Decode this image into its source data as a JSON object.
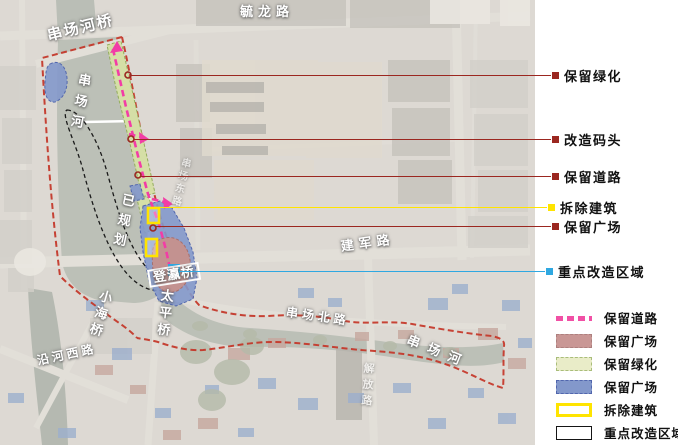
{
  "colors": {
    "callout_red": "#9b2720",
    "demolish_yellow": "#ffe400",
    "focus_cyan": "#2fa8e1",
    "road_magenta": "#f23da6",
    "boundary_red": "#c43527",
    "green_fill": "#d5dfa6",
    "blue_fill": "#8398cb",
    "rose_fill": "#c39290"
  },
  "callouts": [
    {
      "id": "retain-greenery",
      "label": "保留绿化",
      "color": "red",
      "y": 75,
      "x1": 131,
      "x2": 551
    },
    {
      "id": "renovate-dock",
      "label": "改造码头",
      "color": "red",
      "y": 139,
      "x1": 134,
      "x2": 551
    },
    {
      "id": "retain-road",
      "label": "保留道路",
      "color": "red",
      "y": 176,
      "x1": 141,
      "x2": 551
    },
    {
      "id": "demolish-building",
      "label": "拆除建筑",
      "color": "yellow",
      "y": 207,
      "x1": 159,
      "x2": 547
    },
    {
      "id": "retain-plaza",
      "label": "保留广场",
      "color": "red",
      "y": 226,
      "x1": 156,
      "x2": 551
    },
    {
      "id": "key-renovation-area",
      "label": "重点改造区域",
      "color": "cyan",
      "y": 271,
      "x1": 179,
      "x2": 545
    }
  ],
  "legend": {
    "items": [
      {
        "label": "保留道路",
        "swatch": "dash-magenta"
      },
      {
        "label": "保留广场",
        "swatch": "fill-rose"
      },
      {
        "label": "保留绿化",
        "swatch": "fill-green"
      },
      {
        "label": "保留广场",
        "swatch": "fill-blue"
      },
      {
        "label": "拆除建筑",
        "swatch": "outline-yellow"
      },
      {
        "label": "重点改造区域",
        "swatch": "outline-black"
      }
    ]
  },
  "map_labels": [
    {
      "id": "yulong-road",
      "text": "毓龙路",
      "x": 240,
      "y": 5,
      "rot": 0,
      "vertical": false,
      "size": 13,
      "ls": 5
    },
    {
      "id": "chuanchang-river-bridge",
      "text": "串场河桥",
      "x": 46,
      "y": 30,
      "rot": -14,
      "vertical": false,
      "size": 15,
      "ls": 2
    },
    {
      "id": "chuanchang-river-north",
      "text": "串场河",
      "x": 78,
      "y": 72,
      "rot": 10,
      "vertical": true,
      "size": 13,
      "ls": 8
    },
    {
      "id": "planned-area",
      "text": "已规划",
      "x": 122,
      "y": 192,
      "rot": 12,
      "vertical": true,
      "size": 13,
      "ls": 7
    },
    {
      "id": "dengying-bridge",
      "text": "登瀛桥",
      "x": 147,
      "y": 270,
      "rot": -9,
      "vertical": false,
      "size": 13,
      "ls": 1,
      "boxed": true
    },
    {
      "id": "xiaohai-bridge",
      "text": "小海桥",
      "x": 100,
      "y": 288,
      "rot": 16,
      "vertical": true,
      "size": 13,
      "ls": 4
    },
    {
      "id": "taiping-bridge",
      "text": "太平桥",
      "x": 160,
      "y": 288,
      "rot": 6,
      "vertical": true,
      "size": 13,
      "ls": 4
    },
    {
      "id": "yanhe-west-road",
      "text": "沿河西路",
      "x": 36,
      "y": 355,
      "rot": -12,
      "vertical": false,
      "size": 12,
      "ls": 3
    },
    {
      "id": "chuanchang-north-road",
      "text": "串场北路",
      "x": 287,
      "y": 306,
      "rot": 8,
      "vertical": false,
      "size": 12,
      "ls": 4
    },
    {
      "id": "chuanchang-river-east",
      "text": "串场河",
      "x": 410,
      "y": 333,
      "rot": 22,
      "vertical": false,
      "size": 13,
      "ls": 9
    },
    {
      "id": "jianjun-road",
      "text": "建军路",
      "x": 340,
      "y": 240,
      "rot": -8,
      "vertical": false,
      "size": 13,
      "ls": 5
    },
    {
      "id": "jiefang-road",
      "text": "解放路",
      "x": 362,
      "y": 362,
      "rot": 4,
      "vertical": true,
      "size": 11,
      "ls": 5,
      "opacity": 0.55
    },
    {
      "id": "chuanchang-east-road",
      "text": "串场东路",
      "x": 180,
      "y": 156,
      "rot": 14,
      "vertical": true,
      "size": 10,
      "ls": 3,
      "opacity": 0.5
    }
  ]
}
